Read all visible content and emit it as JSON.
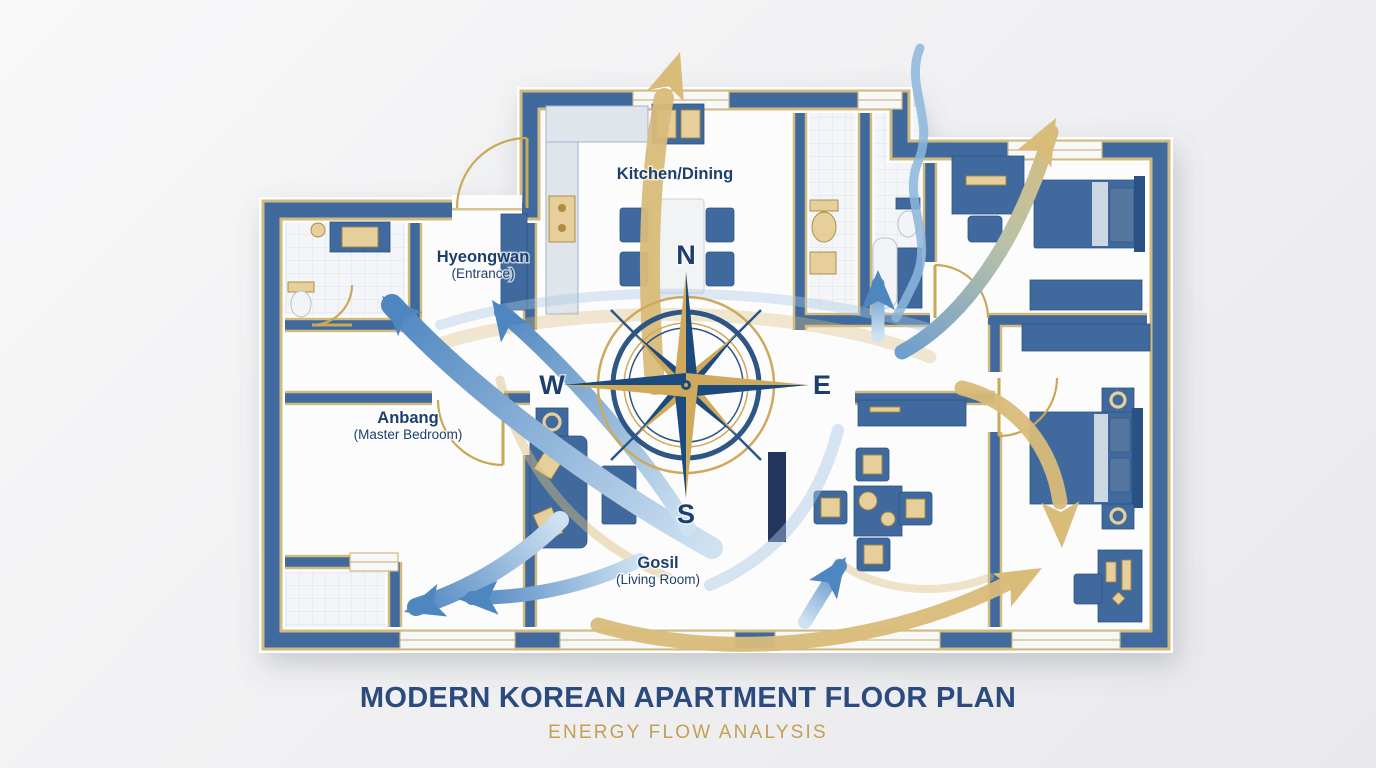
{
  "title": {
    "main": "MODERN KOREAN APARTMENT FLOOR PLAN",
    "subtitle": "ENERGY FLOW ANALYSIS"
  },
  "compass": {
    "north": "N",
    "south": "S",
    "east": "E",
    "west": "W"
  },
  "rooms": {
    "kitchen": {
      "label": "Kitchen/Dining"
    },
    "entrance": {
      "label": "Hyeongwan",
      "sublabel": "(Entrance)"
    },
    "master": {
      "label": "Anbang",
      "sublabel": "(Master Bedroom)"
    },
    "living": {
      "label": "Gosil",
      "sublabel": "(Living Room)"
    }
  },
  "colors": {
    "wall": "#3f6b9e",
    "wallDark": "#2c5183",
    "goldTrim": "#d2b97e",
    "gold": "#c9a959",
    "goldLight": "#e6cf9a",
    "navy": "#1d3f6e",
    "titleNavy": "#2b4a7d",
    "subtitleGold": "#c0a055",
    "arrowGold": "#d9bc7a",
    "arrowBlue": "#4e86c0",
    "arrowBlueLight": "#cfe2f2",
    "floor": "#fcfcfd",
    "tileFill": "#f3f5f8",
    "tileLine": "#dde3ea",
    "counter": "#e0e5eb",
    "furnitureLight": "#54779f",
    "linen": "#ccd7e3",
    "bg1": "#f8f8f9",
    "bg2": "#e9e9ec"
  }
}
